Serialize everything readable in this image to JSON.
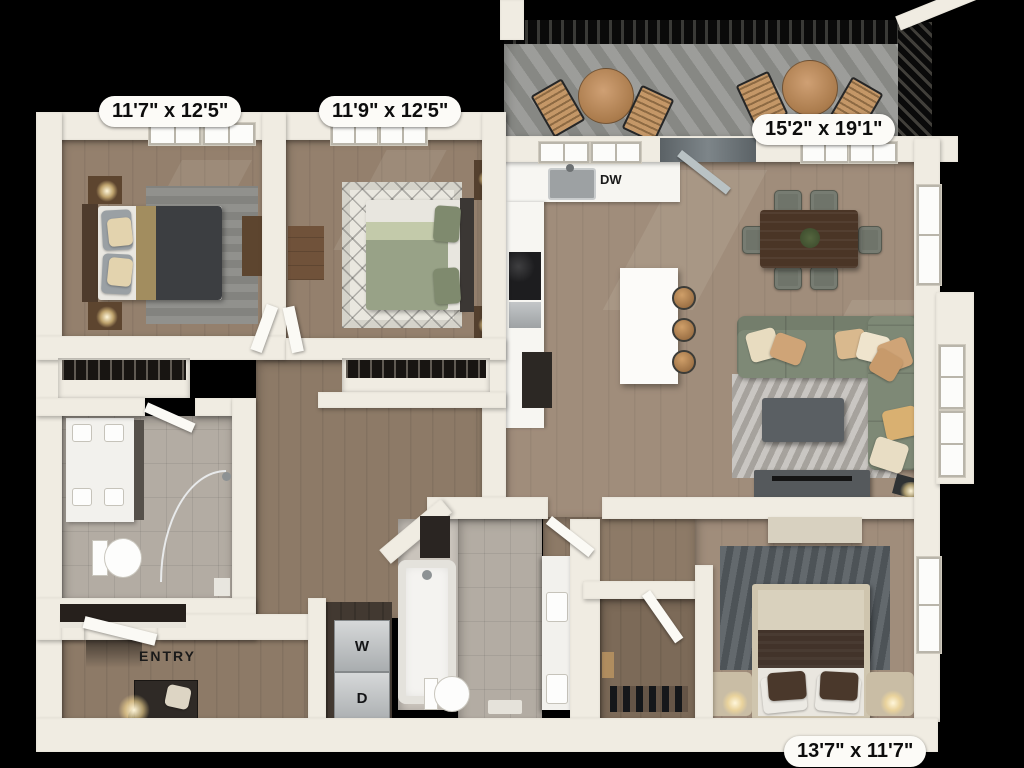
{
  "labels": {
    "bedroom1_dim": "11'7\" x 12'5\"",
    "bedroom2_dim": "11'9\" x 12'5\"",
    "balcony_dim": "15'2\" x 19'1\"",
    "bedroom3_dim": "13'7\" x 11'7\"",
    "entry": "ENTRY",
    "dishwasher": "DW",
    "washer": "W",
    "dryer": "D"
  },
  "colors": {
    "bg": "#000000",
    "wall": "#f0ece2",
    "wood1": "#94806d",
    "wood2": "#a08d7b",
    "woodhall": "#8d7a67",
    "tile": "#b3aca3",
    "deck": "#8f908c",
    "sofa": "#7e8976",
    "bed2duvet": "#98a287",
    "charcoal": "#3c3e41",
    "rugliving": "#b7b3ad",
    "rugdark": "#565c61",
    "tanwood": "#b9824e",
    "darkwood": "#4a3526"
  }
}
